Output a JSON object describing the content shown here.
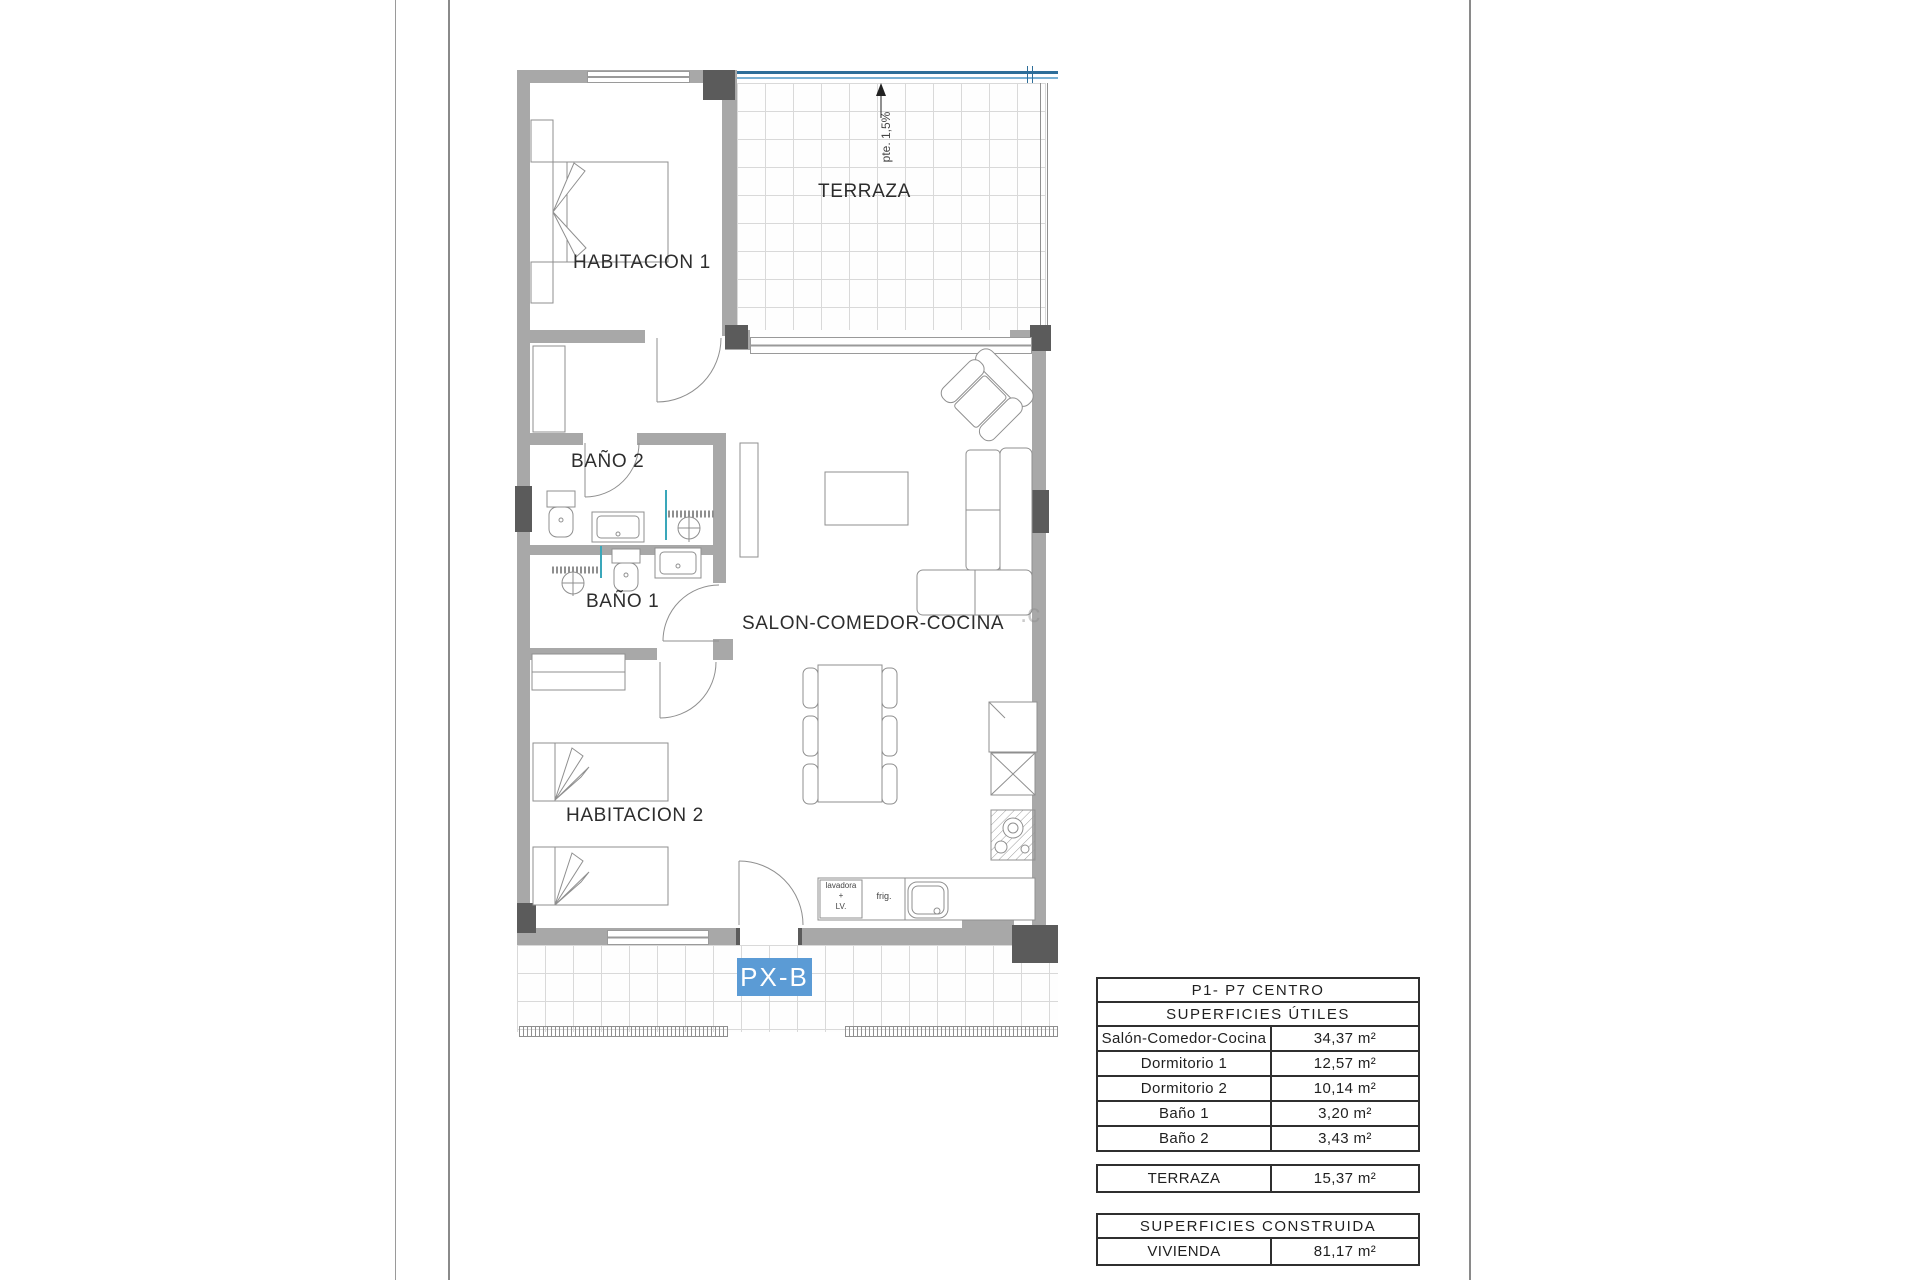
{
  "plan": {
    "labels": {
      "habitacion1": "HABITACION 1",
      "habitacion2": "HABITACION 2",
      "bano2": "BAÑO 2",
      "bano1": "BAÑO 1",
      "salon": "SALON-COMEDOR-COCINA",
      "terraza": "TERRAZA",
      "slope": "pte. 1,5%",
      "unit": "PX-B",
      "washer_note": "lavadora\n+\nLV.",
      "fridge_note": "frig.",
      "watermark": ".c"
    },
    "colors": {
      "wall": "#a8a8a8",
      "pillar": "#5b5b5b",
      "unit_tag_blue": "#5b9bd5",
      "balustrade_blue": "#2e6e99",
      "shower_glass_teal": "#3aa7ba"
    }
  },
  "tables": {
    "useful": {
      "title": "P1- P7 CENTRO",
      "subtitle": "SUPERFICIES ÚTILES",
      "rows": [
        {
          "label": "Salón-Comedor-Cocina",
          "value": "34,37 m²"
        },
        {
          "label": "Dormitorio 1",
          "value": "12,57 m²"
        },
        {
          "label": "Dormitorio 2",
          "value": "10,14 m²"
        },
        {
          "label": "Baño 1",
          "value": "3,20 m²"
        },
        {
          "label": "Baño 2",
          "value": "3,43 m²"
        }
      ]
    },
    "terraza": {
      "rows": [
        {
          "label": "TERRAZA",
          "value": "15,37 m²"
        }
      ]
    },
    "built": {
      "title": "SUPERFICIES CONSTRUIDA",
      "rows": [
        {
          "label": "VIVIENDA",
          "value": "81,17 m²"
        }
      ]
    }
  }
}
